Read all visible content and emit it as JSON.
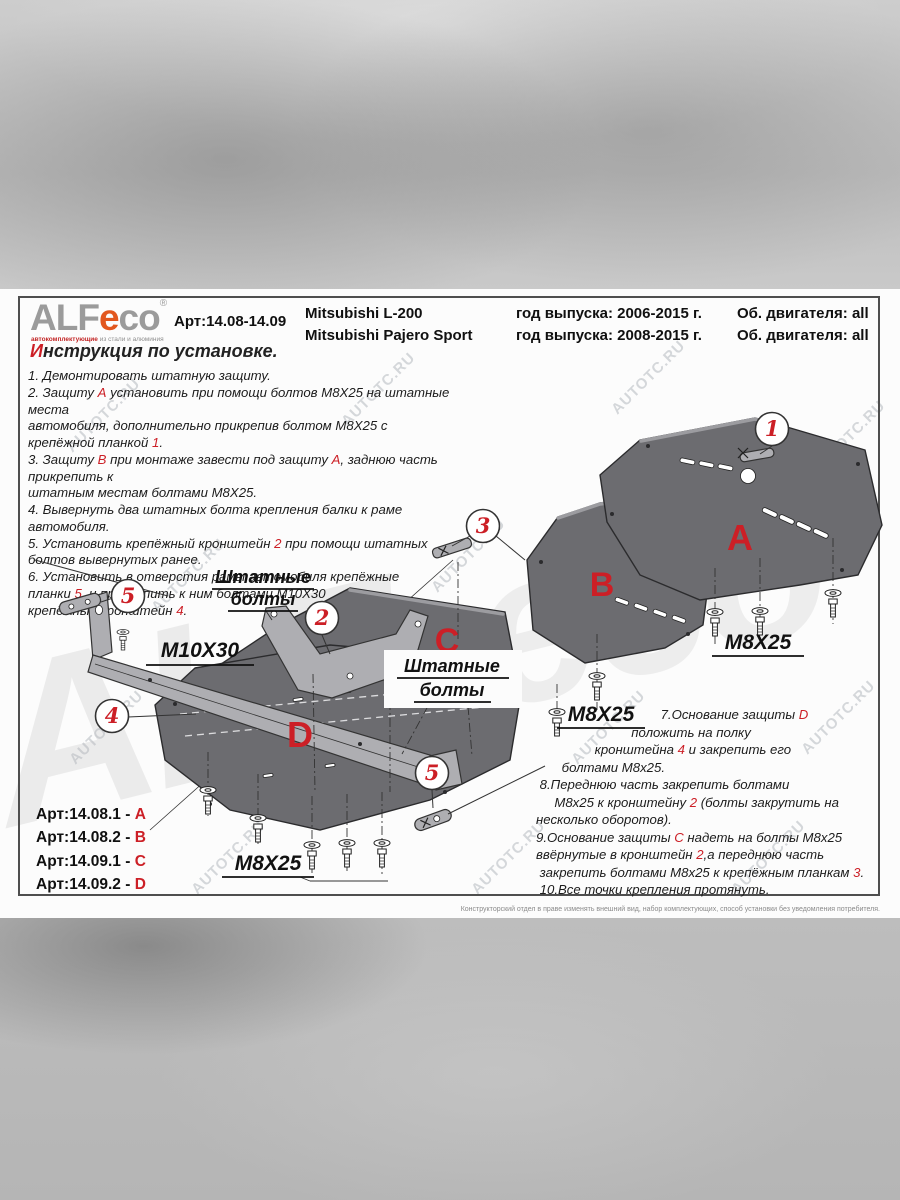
{
  "watermark": {
    "small": "AUTOTC.RU",
    "big1": "ALF",
    "big2": "eco"
  },
  "colors": {
    "accent_red": "#cc1f26",
    "logo_orange": "#e2571f",
    "plate_gray": "#6c6c70"
  },
  "header": {
    "logo": {
      "alf": "ALF",
      "e": "e",
      "co": "co",
      "reg": "®",
      "tagline_red": "автокомплектующие",
      "tagline_gray": " из стали и алюминия"
    },
    "art": "Арт:14.08-14.09",
    "model_1": "Mitsubishi L-200",
    "model_2": "Mitsubishi Pajero Sport",
    "year_1": "год выпуска: 2006-2015 г.",
    "year_2": "год выпуска: 2008-2015 г.",
    "engine_1": "Об. двигателя: all",
    "engine_2": "Об. двигателя: all"
  },
  "title": "*И*нструкция по установке.",
  "steps_left": [
    "1. Демонтировать штатную защиту.",
    "2. Защиту *А* установить при помощи болтов М8Х25 на штатные места\nавтомобиля, дополнительно прикрепив болтом М8Х25 с\nкрепёжной планкой *1*.",
    "3. Защиту *В* при монтаже завести под защиту *А*, заднюю часть прикрепить к\nштатным местам болтами М8Х25.",
    "4. Вывернуть два штатных болта крепления балки к раме автомобиля.",
    "5. Установить крепёжный кронштейн *2* при помощи штатных\nболтов вывернутых ранее.",
    "6. Установить в отверстия рамы автомобиля крепёжные\nпланки *5*  и прикрепить к ним болтами М10Х30\nкрепёжный кронштейн *4*."
  ],
  "steps_right": [
    "                                  7.Основание защиты *D*\n                          положить на полку\n                кронштейна *4* и закрепить его\n       болтами М8х25.",
    " 8.Переднюю часть закрепить болтами\n     М8х25 к кронштейну *2* (болты закрутить на\nнесколько оборотов).",
    "9.Основание защиты *С* надеть на болты М8х25\nввёрнутые в кронштейн *2*,а переднюю часть\n закрепить болтами М8х25 к крепёжным планкам *3*.",
    " 10.Все точки крепления протянуть."
  ],
  "articles": [
    "Арт:14.08.1 - *A*",
    "Арт:14.08.2 - *B*",
    "Арт:14.09.1 - *C*",
    "Арт:14.09.2 - *D*"
  ],
  "diagram": {
    "plate_a": "A",
    "plate_b": "B",
    "plate_c": "C",
    "plate_d": "D",
    "callout_1": "1",
    "callout_2": "2",
    "callout_3": "3",
    "callout_4": "4",
    "callout_5": "5",
    "m8x25": "M8X25",
    "m10x30": "M10X30",
    "stock_bolts_l1": "Штатные",
    "stock_bolts_l2": "болты"
  },
  "footer": "Конструкторский отдел в праве изменять внешний вид, набор комплектующих, способ установки без уведомления потребителя."
}
